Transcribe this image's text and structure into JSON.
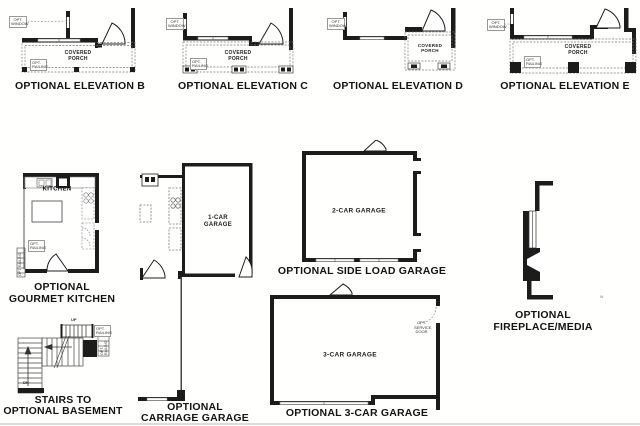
{
  "page": {
    "background": "#ffffff",
    "line_color": "#1c1c1c",
    "sheet_type": "floor plan options"
  },
  "annotations": {
    "opt_window": "OPT. WINDOW",
    "opt_railing": "OPT. RAILING",
    "opt_service_door": "OPT. SERVICE DOOR",
    "covered_porch": "COVERED PORCH",
    "up": "UP",
    "dn": "DN",
    "watermark": "w"
  },
  "panels": {
    "elevation_b": {
      "caption": "OPTIONAL ELEVATION B"
    },
    "elevation_c": {
      "caption": "OPTIONAL ELEVATION C"
    },
    "elevation_d": {
      "caption": "OPTIONAL ELEVATION D"
    },
    "elevation_e": {
      "caption": "OPTIONAL ELEVATION E"
    },
    "gourmet_kitchen": {
      "caption_line1": "OPTIONAL",
      "caption_line2": "GOURMET KITCHEN",
      "room_label": "KITCHEN"
    },
    "carriage_garage": {
      "caption_line1": "OPTIONAL",
      "caption_line2": "CARRIAGE GARAGE",
      "room_label": "1-CAR GARAGE"
    },
    "side_load_garage": {
      "caption": "OPTIONAL SIDE LOAD GARAGE",
      "room_label": "2-CAR GARAGE"
    },
    "three_car_garage": {
      "caption": "OPTIONAL 3-CAR GARAGE",
      "room_label": "3-CAR GARAGE"
    },
    "basement_stairs": {
      "caption_line1": "STAIRS TO",
      "caption_line2": "OPTIONAL BASEMENT"
    },
    "fireplace_media": {
      "caption_line1": "OPTIONAL",
      "caption_line2": "FIREPLACE/MEDIA"
    }
  }
}
